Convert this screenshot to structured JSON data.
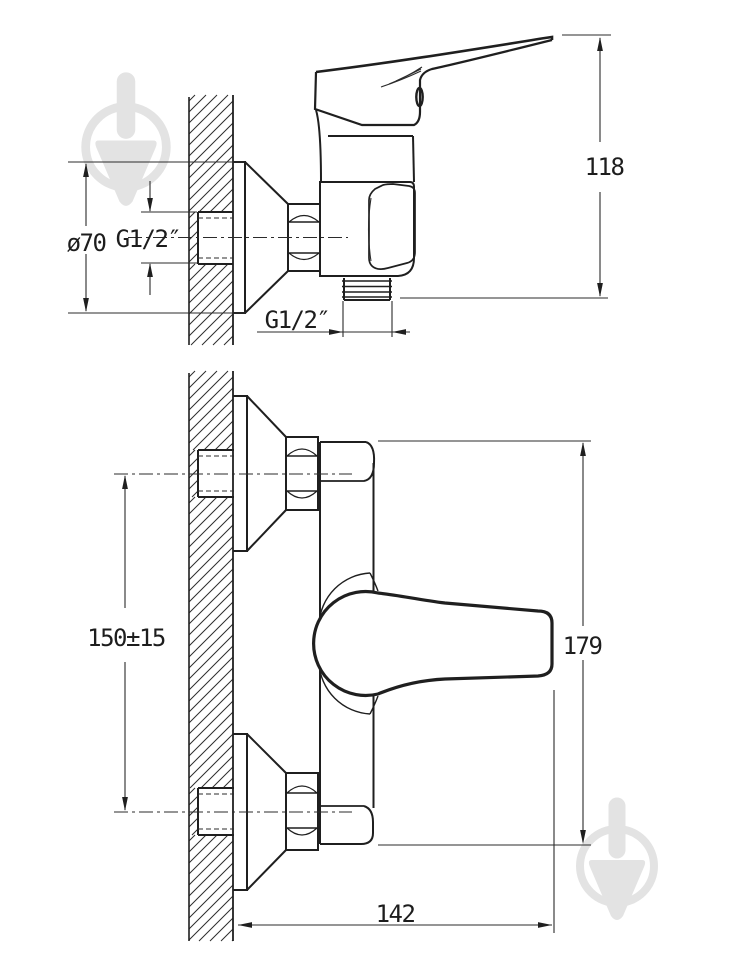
{
  "meta": {
    "type": "technical-drawing",
    "subject": "wall-mounted single-lever shower mixer, two orthographic projection views with dimensions"
  },
  "colors": {
    "background": "#ffffff",
    "outline": "#1f1f1f",
    "thin_line": "#2b2b2b",
    "watermark": "#e3e3e3",
    "text": "#1d1d1d"
  },
  "views": {
    "side": {
      "name": "side-view",
      "labels": {
        "escutcheon_diameter": "ø70",
        "wall_thread": "G1/2″",
        "outlet_thread": "G1/2″",
        "height_to_lever_tip": "118"
      }
    },
    "front": {
      "name": "front-view",
      "labels": {
        "connection_center_distance": "150±15",
        "overall_height": "179",
        "overall_depth": "142"
      }
    }
  },
  "watermarks": {
    "icon": "trowel-in-circle-icon",
    "positions": [
      "top-left",
      "bottom-right"
    ]
  }
}
